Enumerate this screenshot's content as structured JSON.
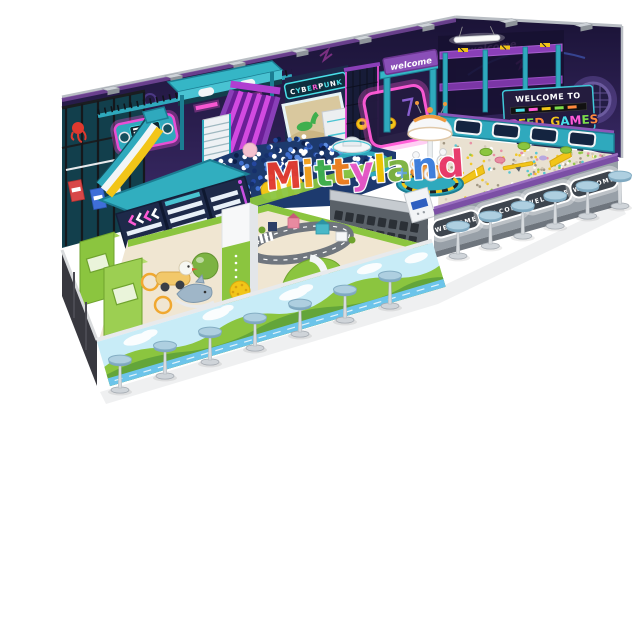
{
  "scene": {
    "subject": "isometric 3D render of a cyberpunk-theme indoor playground on a white background",
    "background": "#ffffff"
  },
  "watermark": {
    "text": "Mittyland",
    "letters": [
      {
        "ch": "M",
        "color": "#e23b30"
      },
      {
        "ch": "i",
        "color": "#f6a21c"
      },
      {
        "ch": "t",
        "color": "#3faf4e"
      },
      {
        "ch": "t",
        "color": "#f08020"
      },
      {
        "ch": "y",
        "color": "#e857c8"
      },
      {
        "ch": "l",
        "color": "#f2c400"
      },
      {
        "ch": "a",
        "color": "#7cb342"
      },
      {
        "ch": "n",
        "color": "#3b7ddd"
      },
      {
        "ch": "d",
        "color": "#e8386a"
      }
    ]
  },
  "signs": {
    "cyberpunk": {
      "text": "CYBERPUNK",
      "letters": [
        {
          "ch": "C",
          "color": "#ffffff"
        },
        {
          "ch": "Y",
          "color": "#49e0e8"
        },
        {
          "ch": "B",
          "color": "#ffffff"
        },
        {
          "ch": "E",
          "color": "#49e0e8"
        },
        {
          "ch": "R",
          "color": "#ff5ad6"
        },
        {
          "ch": "P",
          "color": "#ffffff"
        },
        {
          "ch": "U",
          "color": "#49e0e8"
        },
        {
          "ch": "N",
          "color": "#ffffff"
        },
        {
          "ch": "K",
          "color": "#49e0e8"
        }
      ]
    },
    "welcome_banner": "welcome",
    "welcome_neon": "welcome",
    "welcome_to": "WELCOME TO",
    "speed_games": {
      "text": "SPEED GAMES",
      "letters": [
        {
          "ch": "S",
          "color": "#49e0e8"
        },
        {
          "ch": "P",
          "color": "#ff5ad6"
        },
        {
          "ch": "E",
          "color": "#f2c518"
        },
        {
          "ch": "E",
          "color": "#7cdd4a"
        },
        {
          "ch": "D",
          "color": "#ff8a3d"
        },
        {
          "ch": " ",
          "color": "#ffffff"
        },
        {
          "ch": "G",
          "color": "#f2c518"
        },
        {
          "ch": "A",
          "color": "#49e0e8"
        },
        {
          "ch": "M",
          "color": "#ff5ad6"
        },
        {
          "ch": "E",
          "color": "#7cdd4a"
        },
        {
          "ch": "S",
          "color": "#ff8a3d"
        }
      ]
    },
    "led_panel": "WELCOME"
  },
  "counts": {
    "stools_left": 7,
    "stools_right": 6,
    "led_panels": 4,
    "window_frames": 4,
    "vents_back_left": 6,
    "vents_back_right": 2
  },
  "palette": {
    "teal": "#2fa9bd",
    "teal_dark": "#1b7e93",
    "navy_wall": "#241c45",
    "magenta_neon": "#ff5ad6",
    "purple": "#8a3fb8",
    "green": "#8bc53f",
    "sand": "#e9e1d1",
    "gray_wall": "#98a0a8",
    "stool_seat": "#a7cbdc",
    "ball_colors": [
      "#16306b",
      "#24479e",
      "#3f6fd0",
      "#5d8de0",
      "#ffffff",
      "#ffffff",
      "#ffffff",
      "#0d1f4a"
    ],
    "sand_speckles": [
      "#e88aa0",
      "#8bc53f",
      "#49c3d2",
      "#f2c518",
      "#ffffff",
      "#cfc4b2",
      "#9a8f7a"
    ]
  }
}
